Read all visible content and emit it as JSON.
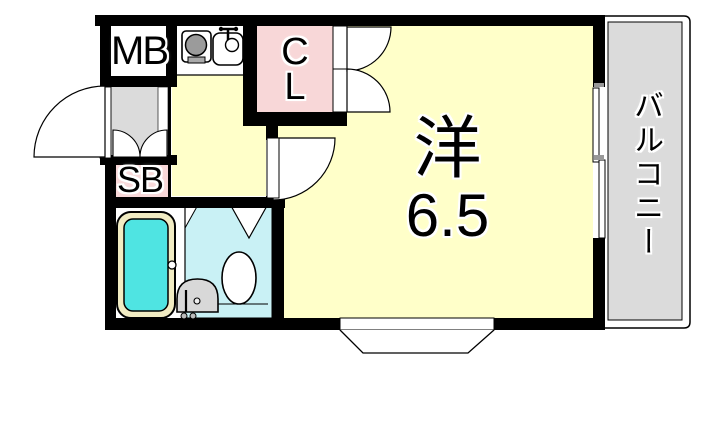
{
  "floorplan": {
    "labels": {
      "meter_box": "MB",
      "closet": "C\nL",
      "shoe_box": "SB",
      "main_room_name": "洋",
      "main_room_size": "6.5",
      "balcony": "バルコニー"
    },
    "colors": {
      "wall": "#000000",
      "floor_yellow": "#FFFFC9",
      "closet_pink": "#F8D7D8",
      "shoe_box_pink": "#F8D7D8",
      "gray_area": "#DBDBDB",
      "bathtub_water": "#4FE4E2",
      "bathtub_rim": "#F1ECC3",
      "toilet_room_cyan": "#C9F1F5",
      "fixture_gray": "#D8D8D8",
      "stove_burner_gray": "#9B9B9B"
    },
    "fixtures": [
      "entrance-door",
      "shoe-box-doors",
      "closet-doors",
      "room-door",
      "stove",
      "kitchen-sink",
      "bathtub",
      "toilet",
      "washbasin",
      "sliding-window",
      "bay-window",
      "balcony-railing"
    ]
  }
}
